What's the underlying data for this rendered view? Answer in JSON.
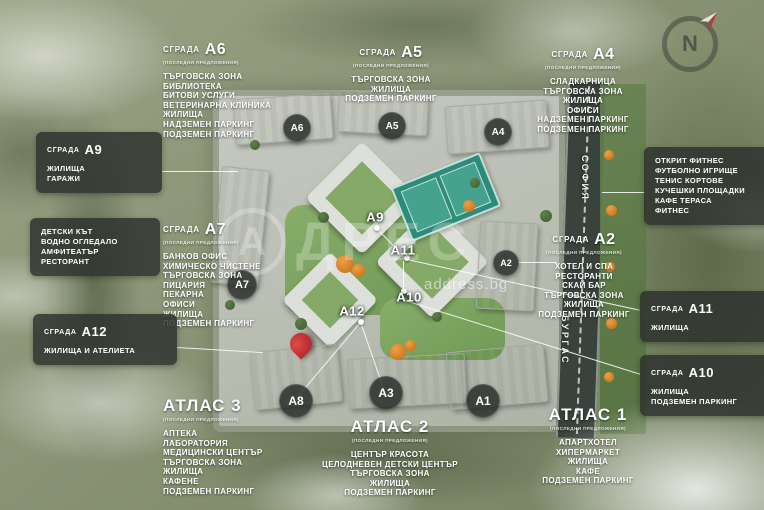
{
  "colors": {
    "pin_red": "#c3272b",
    "callout_box_bg": "rgba(44,48,44,0.82)",
    "badge_chip_bg": "rgba(38,42,38,0.82)",
    "text_white": "#ffffff",
    "lawn_green": "#7ea45e",
    "tennis_teal": "#2e8b7b",
    "road_gray": "#39423c"
  },
  "compass": {
    "label": "N"
  },
  "watermark": {
    "logo_letter": "А",
    "brand": "ДРЕС",
    "domain": "address.bg"
  },
  "roads": {
    "sofia": "СОФИЯ",
    "burgas": "БУРГАС"
  },
  "badges_chips": [
    "A6",
    "A5",
    "A4",
    "A7",
    "A2",
    "A8",
    "A3",
    "A1"
  ],
  "badges_plain": [
    "A9",
    "A11",
    "A10",
    "A12"
  ],
  "callouts": {
    "a6": {
      "prefix": "СГРАДА",
      "code": "A6",
      "subtitle": "(ПОСЛЕДНИ ПРЕДЛОЖЕНИЯ)",
      "items": [
        "ТЪРГОВСКА ЗОНА",
        "БИБЛИОТЕКА",
        "БИТОВИ УСЛУГИ",
        "ВЕТЕРИНАРНА КЛИНИКА",
        "ЖИЛИЩА",
        "НАДЗЕМЕН ПАРКИНГ",
        "ПОДЗЕМЕН ПАРКИНГ"
      ]
    },
    "a5": {
      "prefix": "СГРАДА",
      "code": "A5",
      "subtitle": "(ПОСЛЕДНИ ПРЕДЛОЖЕНИЯ)",
      "items": [
        "ТЪРГОВСКА ЗОНА",
        "ЖИЛИЩА",
        "ПОДЗЕМЕН ПАРКИНГ"
      ]
    },
    "a4": {
      "prefix": "СГРАДА",
      "code": "A4",
      "subtitle": "(ПОСЛЕДНИ ПРЕДЛОЖЕНИЯ)",
      "items": [
        "СЛАДКАРНИЦА",
        "ТЪРГОВСКА ЗОНА",
        "ЖИЛИЩА",
        "ОФИСИ",
        "НАДЗЕМЕН ПАРКИНГ",
        "ПОДЗЕМЕН ПАРКИНГ"
      ]
    },
    "a9": {
      "prefix": "СГРАДА",
      "code": "A9",
      "items": [
        "ЖИЛИЩА",
        "ГАРАЖИ"
      ]
    },
    "kids_area": {
      "items": [
        "ДЕТСКИ КЪТ",
        "ВОДНО ОГЛЕДАЛО",
        "АМФИТЕАТЪР",
        "РЕСТОРАНТ"
      ]
    },
    "a7": {
      "prefix": "СГРАДА",
      "code": "A7",
      "subtitle": "(ПОСЛЕДНИ ПРЕДЛОЖЕНИЯ)",
      "items": [
        "БАНКОВ ОФИС",
        "ХИМИЧЕСКО ЧИСТЕНЕ",
        "ТЪРГОВСКА ЗОНА",
        "ПИЦАРИЯ",
        "ПЕКАРНА",
        "ОФИСИ",
        "ЖИЛИЩА",
        "ПОДЗЕМЕН ПАРКИНГ"
      ]
    },
    "a12": {
      "prefix": "СГРАДА",
      "code": "A12",
      "items": [
        "ЖИЛИЩА И АТЕЛИЕТА"
      ]
    },
    "atlas3": {
      "title": "АТЛАС 3",
      "subtitle": "(ПОСЛЕДНИ ПРЕДЛОЖЕНИЯ)",
      "items": [
        "АПТЕКА",
        "ЛАБОРАТОРИЯ",
        "МЕДИЦИНСКИ ЦЕНТЪР",
        "ТЪРГОВСКА ЗОНА",
        "ЖИЛИЩА",
        "КАФЕНЕ",
        "ПОДЗЕМЕН ПАРКИНГ"
      ]
    },
    "atlas2": {
      "title": "АТЛАС 2",
      "subtitle": "(ПОСЛЕДНИ ПРЕДЛОЖЕНИЯ)",
      "items": [
        "ЦЕНТЪР КРАСОТА",
        "ЦЕЛОДНЕВЕН ДЕТСКИ ЦЕНТЪР",
        "ТЪРГОВСКА ЗОНА",
        "ЖИЛИЩА",
        "ПОДЗЕМЕН ПАРКИНГ"
      ]
    },
    "atlas1": {
      "title": "АТЛАС 1",
      "subtitle": "(ПОСЛЕДНИ ПРЕДЛОЖЕНИЯ)",
      "items": [
        "АПАРТХОТЕЛ",
        "ХИПЕРМАРКЕТ",
        "ЖИЛИЩА",
        "КАФЕ",
        "ПОДЗЕМЕН ПАРКИНГ"
      ]
    },
    "sports_area": {
      "items": [
        "ОТКРИТ ФИТНЕС",
        "ФУТБОЛНО ИГРИЩЕ",
        "ТЕНИС КОРТОВЕ",
        "КУЧЕШКИ ПЛОЩАДКИ",
        "КАФЕ ТЕРАСА",
        "ФИТНЕС"
      ]
    },
    "a2": {
      "prefix": "СГРАДА",
      "code": "A2",
      "subtitle": "(ПОСЛЕДНИ ПРЕДЛОЖЕНИЯ)",
      "items": [
        "ХОТЕЛ И СПА",
        "РЕСТОРАНТИ",
        "СКАЙ БАР",
        "ТЪРГОВСКА ЗОНА",
        "ЖИЛИЩА",
        "ПОДЗЕМЕН ПАРКИНГ"
      ]
    },
    "a11": {
      "prefix": "СГРАДА",
      "code": "A11",
      "items": [
        "ЖИЛИЩА"
      ]
    },
    "a10": {
      "prefix": "СГРАДА",
      "code": "A10",
      "items": [
        "ЖИЛИЩА",
        "ПОДЗЕМЕН ПАРКИНГ"
      ]
    }
  }
}
